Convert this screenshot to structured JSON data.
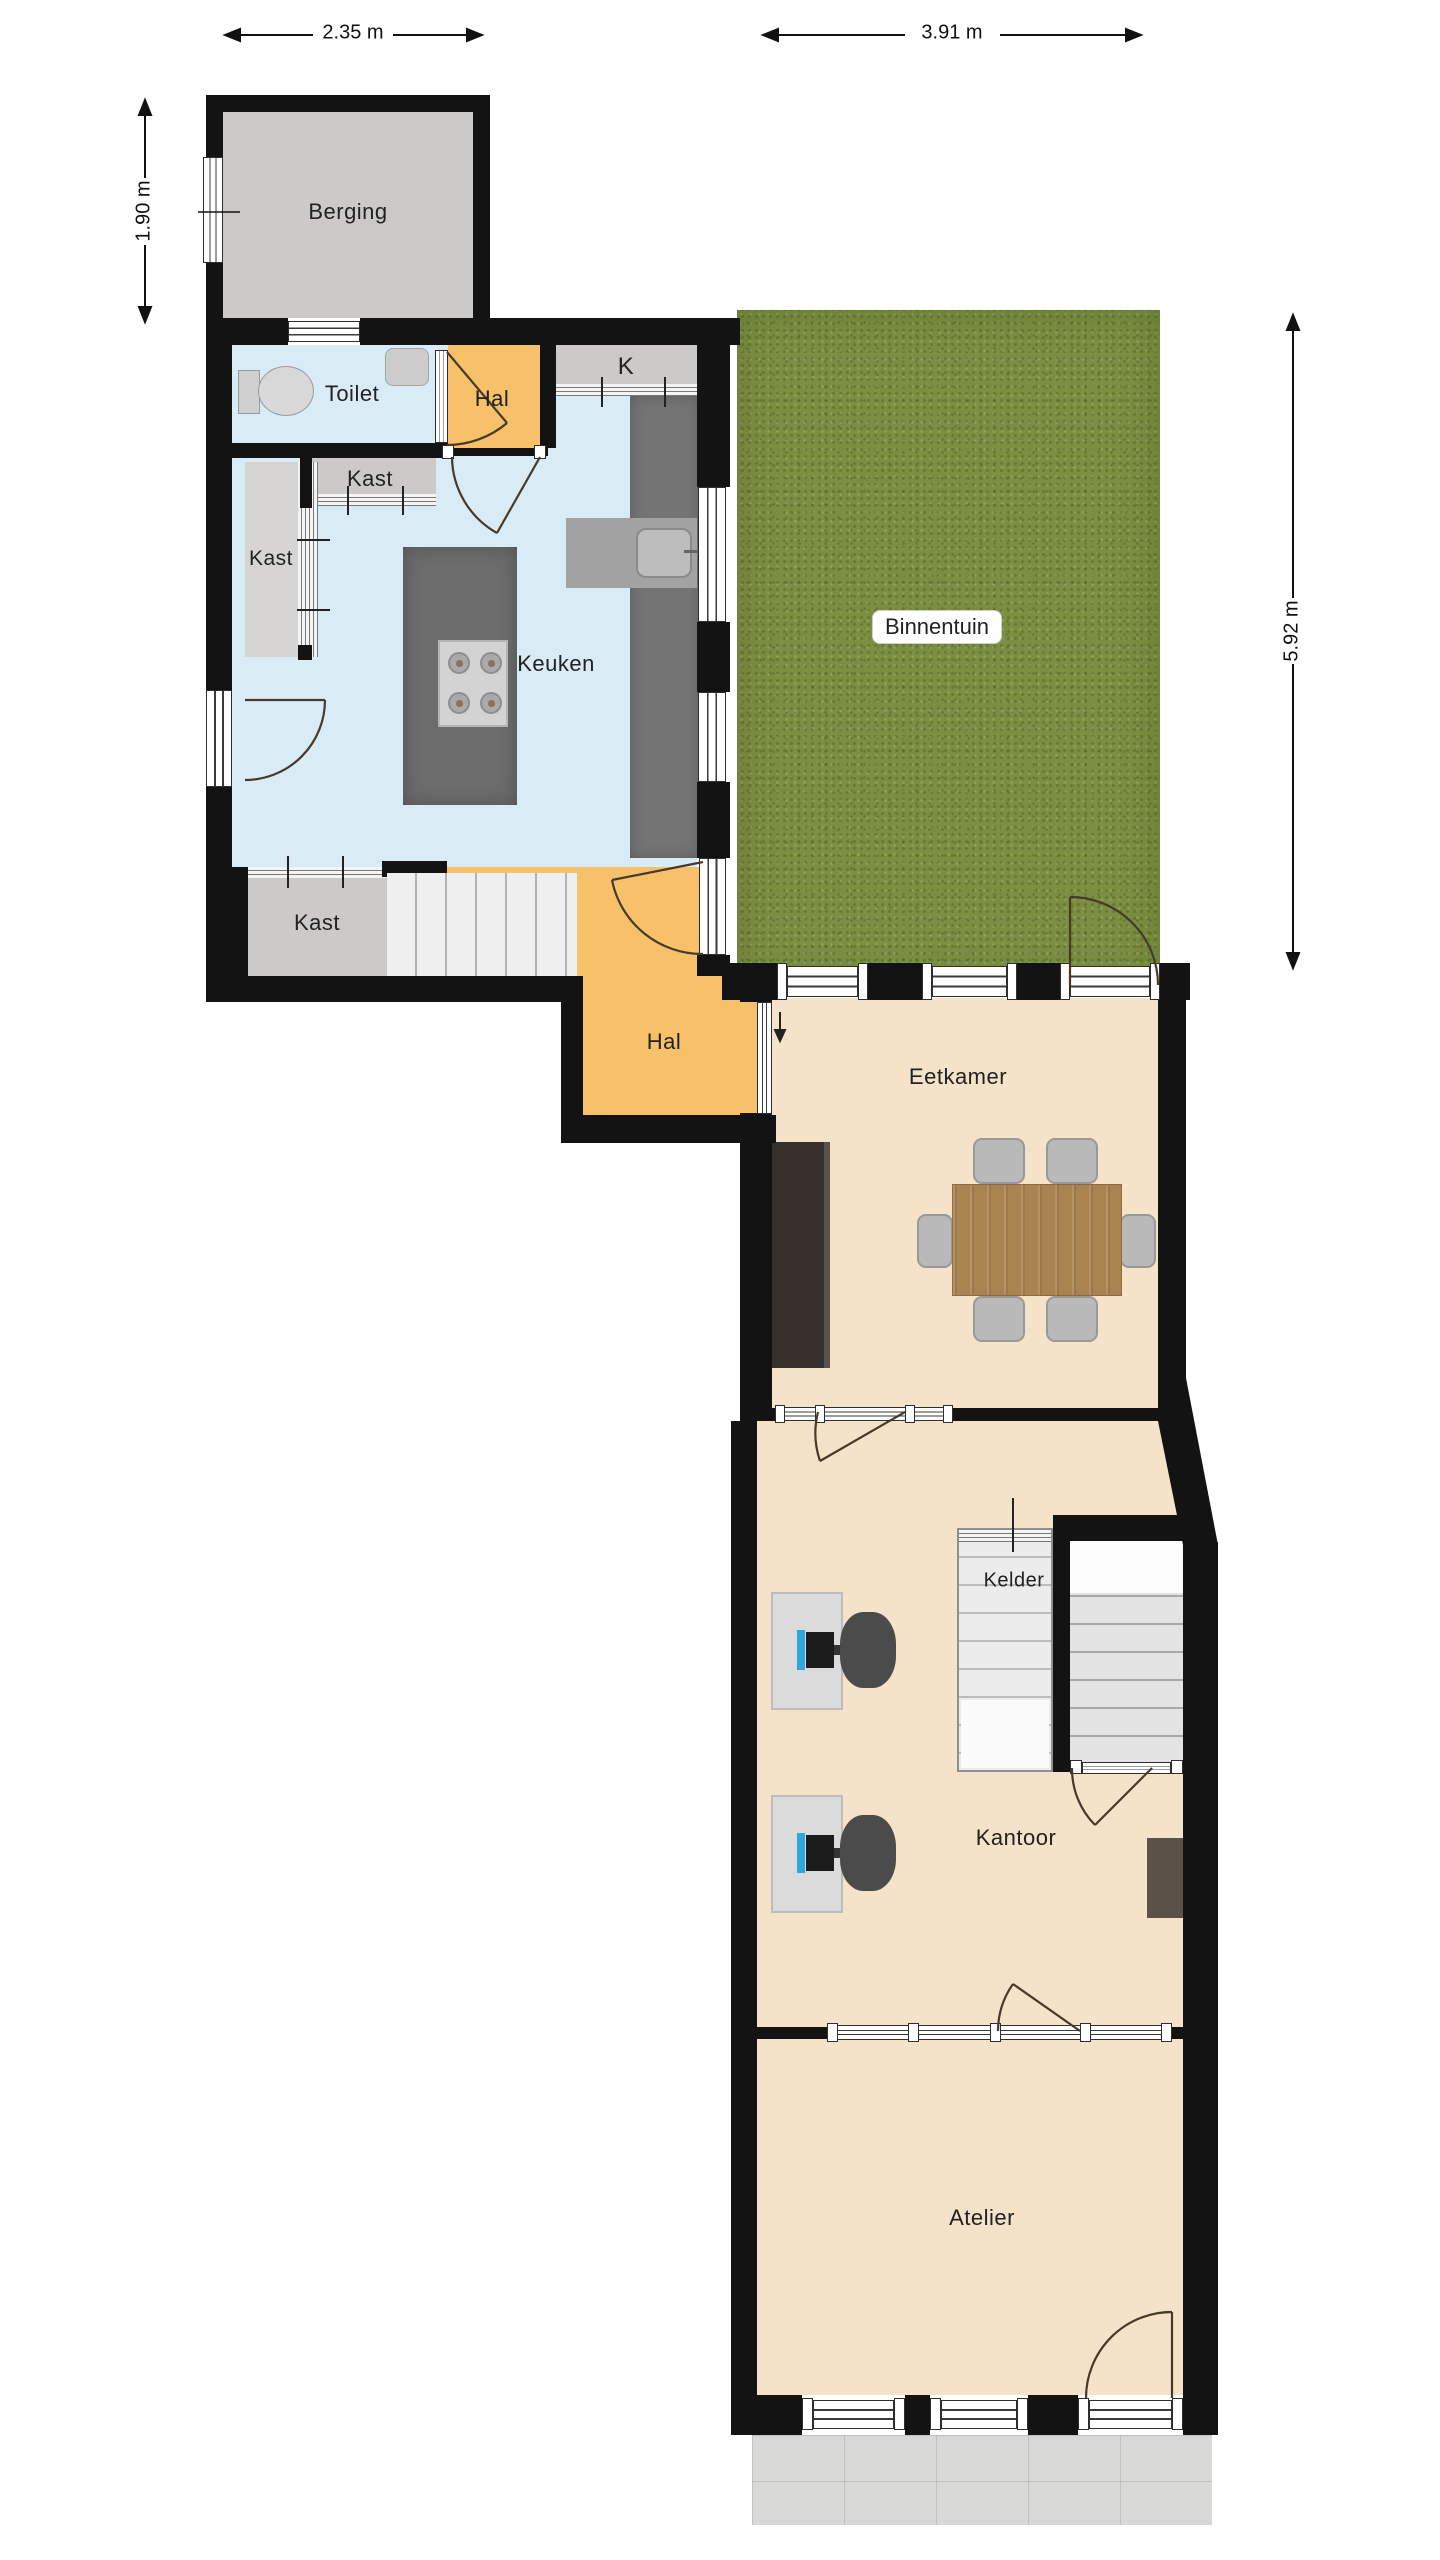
{
  "dimensions": {
    "top_left": "2.35 m",
    "top_right": "3.91 m",
    "left": "1.90 m",
    "right": "5.92 m"
  },
  "rooms": {
    "berging": "Berging",
    "toilet": "Toilet",
    "hal_top": "Hal",
    "kitchenette": "K",
    "kast_top": "Kast",
    "kast_left": "Kast",
    "keuken": "Keuken",
    "binnentuin": "Binnentuin",
    "kast_bottom": "Kast",
    "hal_bottom": "Hal",
    "eetkamer": "Eetkamer",
    "kelder": "Kelder",
    "kantoor": "Kantoor",
    "atelier": "Atelier"
  },
  "colors": {
    "wall": "#131313",
    "room_blue": "#d9ecf5",
    "room_orange": "#f6c169",
    "room_beige": "#f5e3c9",
    "room_gray": "#cbcac8",
    "grass": "#7c8f41",
    "counter": "#747474",
    "island": "#6c6c6c",
    "terrace": "#d8d8d6",
    "wood": "#a98350",
    "door_arc": "#473a2b",
    "text": "#222222"
  }
}
